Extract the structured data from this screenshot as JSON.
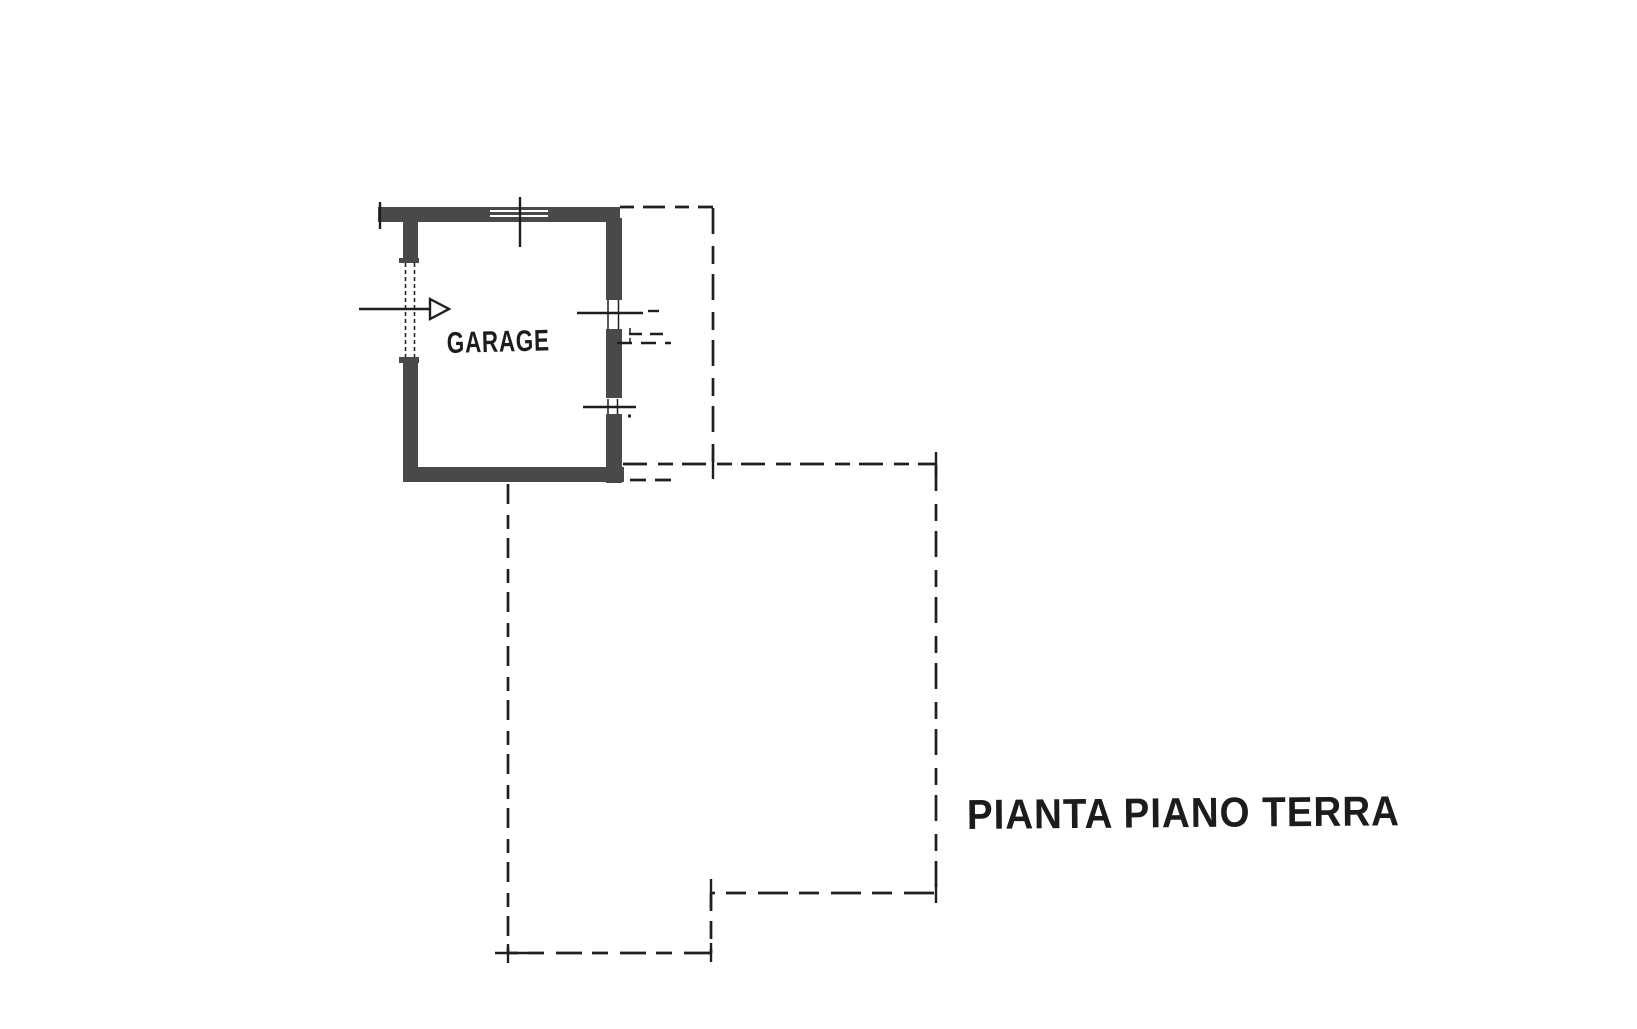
{
  "labels": {
    "garage": "GARAGE",
    "caption": "PIANTA PIANO TERRA"
  },
  "colors": {
    "background": "#ffffff",
    "wall": "#49494b",
    "line": "#1f1f1f",
    "text": "#1c1c1c"
  },
  "icons": {
    "entrance_arrow": "arrow-right"
  }
}
